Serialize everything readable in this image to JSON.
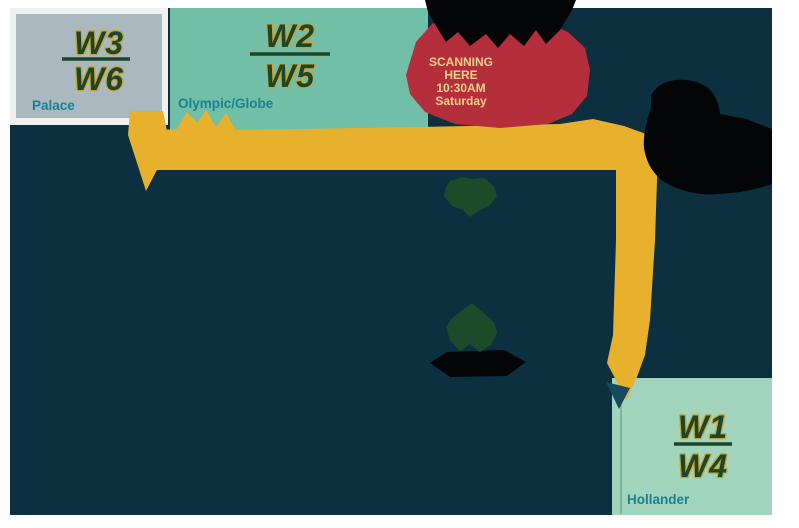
{
  "colors": {
    "page": "#ffffff",
    "background": "#0c3040",
    "route": "#e7b12e",
    "route_arrow": "#174a5e",
    "scanning_box": "#b52e3c",
    "scanning_text": "#eed289",
    "palace_box": "#a9b9bf",
    "palace_frame": "#eef1f1",
    "olympic_box": "#72bfa7",
    "hollander_box": "#a0d4bc",
    "station_label": "#1a8092",
    "wave_fill": "#1d4527",
    "wave_stroke": "#c8a435",
    "marker": "#1d4b2a",
    "silhouette": "#040507",
    "street_line": "#7fb2a0"
  },
  "stations": [
    {
      "id": "palace",
      "wave_top": "W3",
      "wave_bottom": "W6",
      "name": "Palace"
    },
    {
      "id": "olympic-globe",
      "wave_top": "W2",
      "wave_bottom": "W5",
      "name": "Olympic/Globe"
    },
    {
      "id": "hollander",
      "wave_top": "W1",
      "wave_bottom": "W4",
      "name": "Hollander"
    }
  ],
  "scanning_notice": {
    "lines": [
      "SCANNING",
      "HERE",
      "10:30AM",
      "Saturday"
    ]
  },
  "icons": {
    "upper_marker": "green-landmark-marker-icon",
    "lower_marker": "green-landmark-marker-icon",
    "route_end_arrow": "down-arrow-icon"
  }
}
